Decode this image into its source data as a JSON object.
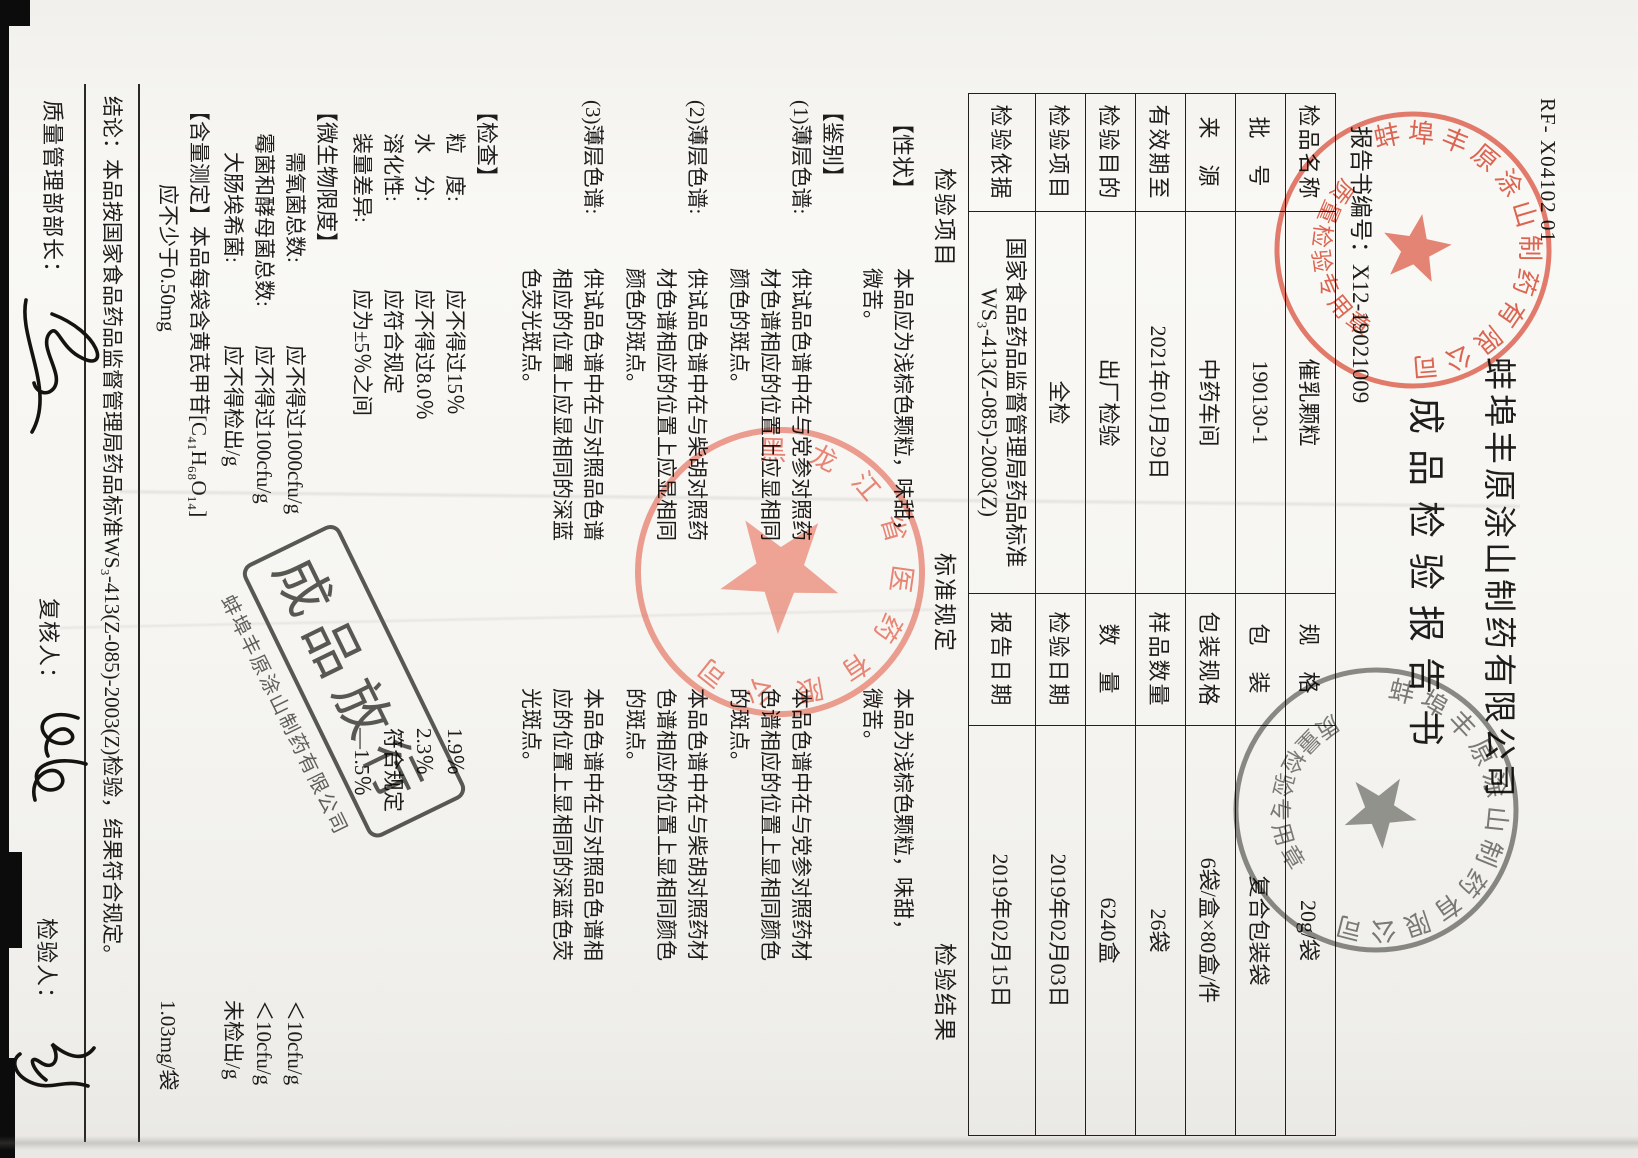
{
  "page": {
    "form_code": "RF- X04102 01",
    "company": "蚌埠丰原涂山制药有限公司",
    "title": "成品检验报告书",
    "report_no_label": "报告书编号：",
    "report_no": "X12-19021009"
  },
  "info_table": {
    "rows": [
      [
        "检品名称",
        "催乳颗粒",
        "规　格",
        "20g/袋"
      ],
      [
        "批　号",
        "190130-1",
        "包　装",
        "复合包装袋"
      ],
      [
        "来　源",
        "中药车间",
        "包装规格",
        "6袋/盒×80盒/件"
      ],
      [
        "有效期至",
        "2021年01月29日",
        "样品数量",
        "26袋"
      ],
      [
        "检验目的",
        "出厂检验",
        "数　量",
        "6240盒"
      ],
      [
        "检验项目",
        "全检",
        "检验日期",
        "2019年02月03日"
      ],
      [
        "检验依据",
        "国家食品药品监督管理局药品标准\nWS₃-413(Z-085)-2003(Z)",
        "报告日期",
        "2019年02月15日"
      ]
    ]
  },
  "columns": {
    "item": "检验项目",
    "standard": "标准规定",
    "result": "检验结果"
  },
  "body": {
    "xingzhuang": {
      "label": "【性状】",
      "std": "本品应为浅棕色颗粒，味甜，\n微苦。",
      "res": "本品为浅棕色颗粒，味甜，\n微苦。"
    },
    "jianbie": {
      "label": "【鉴别】"
    },
    "tlc1": {
      "label": "(1)薄层色谱:",
      "std": "供试品色谱中在与党参对照药\n材色谱相应的位置上应显相同\n颜色的斑点。",
      "res": "本品色谱中在与党参对照药材\n色谱相应的位置上显相同颜色\n的斑点。"
    },
    "tlc2": {
      "label": "(2)薄层色谱:",
      "std": "供试品色谱中在与柴胡对照药\n材色谱相应的位置上应显相同\n颜色的斑点。",
      "res": "本品色谱中在与柴胡对照药材\n色谱相应的位置上显相同颜色\n的斑点。"
    },
    "tlc3": {
      "label": "(3)薄层色谱:",
      "std": "供试品色谱中在与对照品色谱\n相应的位置上应显相同的深蓝\n色荧光斑点。",
      "res": "本品色谱中在与对照品色谱相\n应的位置上显相同的深蓝色荧\n光斑点。"
    },
    "jiancha": {
      "label": "【检查】"
    },
    "lidu": {
      "label": "粒　度:",
      "std": "应不得过15％",
      "res": "1.9％"
    },
    "shuifen": {
      "label": "水　分:",
      "std": "应不得过8.0％",
      "res": "2.3％"
    },
    "ronghua": {
      "label": "溶化性:",
      "std": "应符合规定",
      "res": "符合规定"
    },
    "zhuangliang": {
      "label": "装量差异:",
      "std": "应为±5％之间",
      "res": "—1.5％"
    },
    "weishengwu": {
      "label": "【微生物限度】"
    },
    "xuyang": {
      "label": "需氧菌总数:",
      "std": "应不得过1000cfu/g",
      "res": "＜10cfu/g"
    },
    "meijun": {
      "label": "霉菌和酵母菌总数:",
      "std": "应不得过100cfu/g",
      "res": "＜10cfu/g"
    },
    "dachang": {
      "label": "大肠埃希菌:",
      "std": "应不得检出/g",
      "res": "未检出/g"
    },
    "hanliang": {
      "label": "【含量测定】本品每袋含黄芪甲苷[C₄₁H₆₈O₁₄]\n　　　　应不少于0.50mg",
      "res": "1.03mg/袋"
    }
  },
  "conclusion": "结论：本品按国家食品药品监督管理局药品标准WS₃-413(Z-085)-2003(Z)检验，结果符合规定。",
  "signatures": {
    "manager_label": "质量管理部部长：",
    "reviewer_label": "复核人：",
    "inspector_label": "检验人："
  },
  "stamps": {
    "qc_red": {
      "ring": "蚌埠丰原涂山制药有限公司",
      "bottom": "质量检验专用章"
    },
    "qc_dark": {
      "ring": "蚌埠丰原涂山制药有限公司",
      "bottom": "质量检验专用章"
    },
    "receiver_red": {
      "ring": "黑龙江省医药有限公司"
    },
    "release": {
      "text": "成品放行",
      "sub": "蚌埠丰原涂山制药有限公司"
    }
  }
}
